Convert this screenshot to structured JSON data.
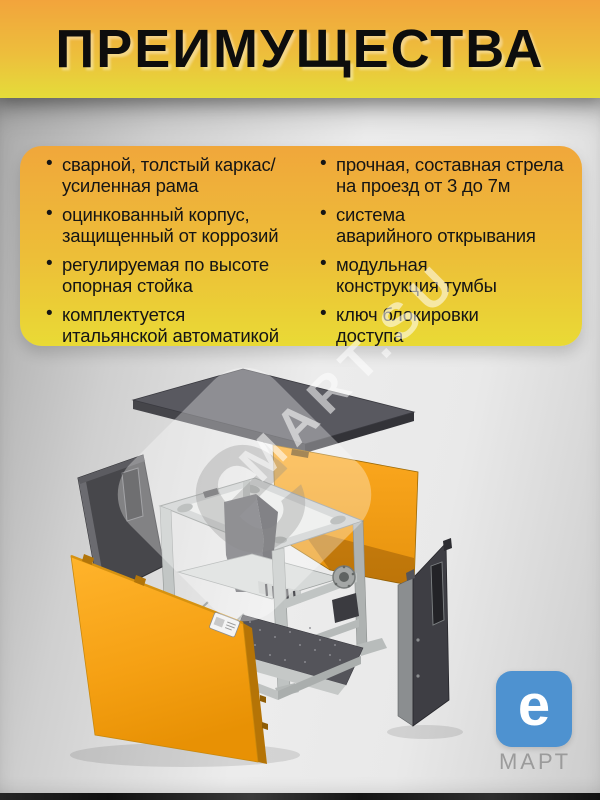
{
  "title": "ПРЕИМУЩЕСТВА",
  "advantages": {
    "bullet": "•",
    "left": [
      "сварной, толстый каркас/\nусиленная рама",
      "оцинкованный корпус,\nзащищенный от коррозий",
      "регулируемая по высоте\nопорная стойка",
      "комплектуется\nитальянской автоматикой"
    ],
    "right": [
      "прочная, составная стрела\nна проезд от 3 до 7м",
      "система\nаварийного открывания",
      "модульная\nконструкция тумбы",
      "ключ блокировки\nдоступа"
    ]
  },
  "watermark": {
    "emblem_letter": "e",
    "text": "MART.SU"
  },
  "brand": {
    "logo_letter": "e",
    "logo_name": "МАРТ"
  },
  "colors": {
    "banner_orange": "#F2A43C",
    "banner_yellow": "#E5DC3A",
    "card_orange": "#F0A73B",
    "card_yellow": "#E9DA35",
    "panel_orange": "#F5A01A",
    "logo_blue": "#4E92D0"
  }
}
